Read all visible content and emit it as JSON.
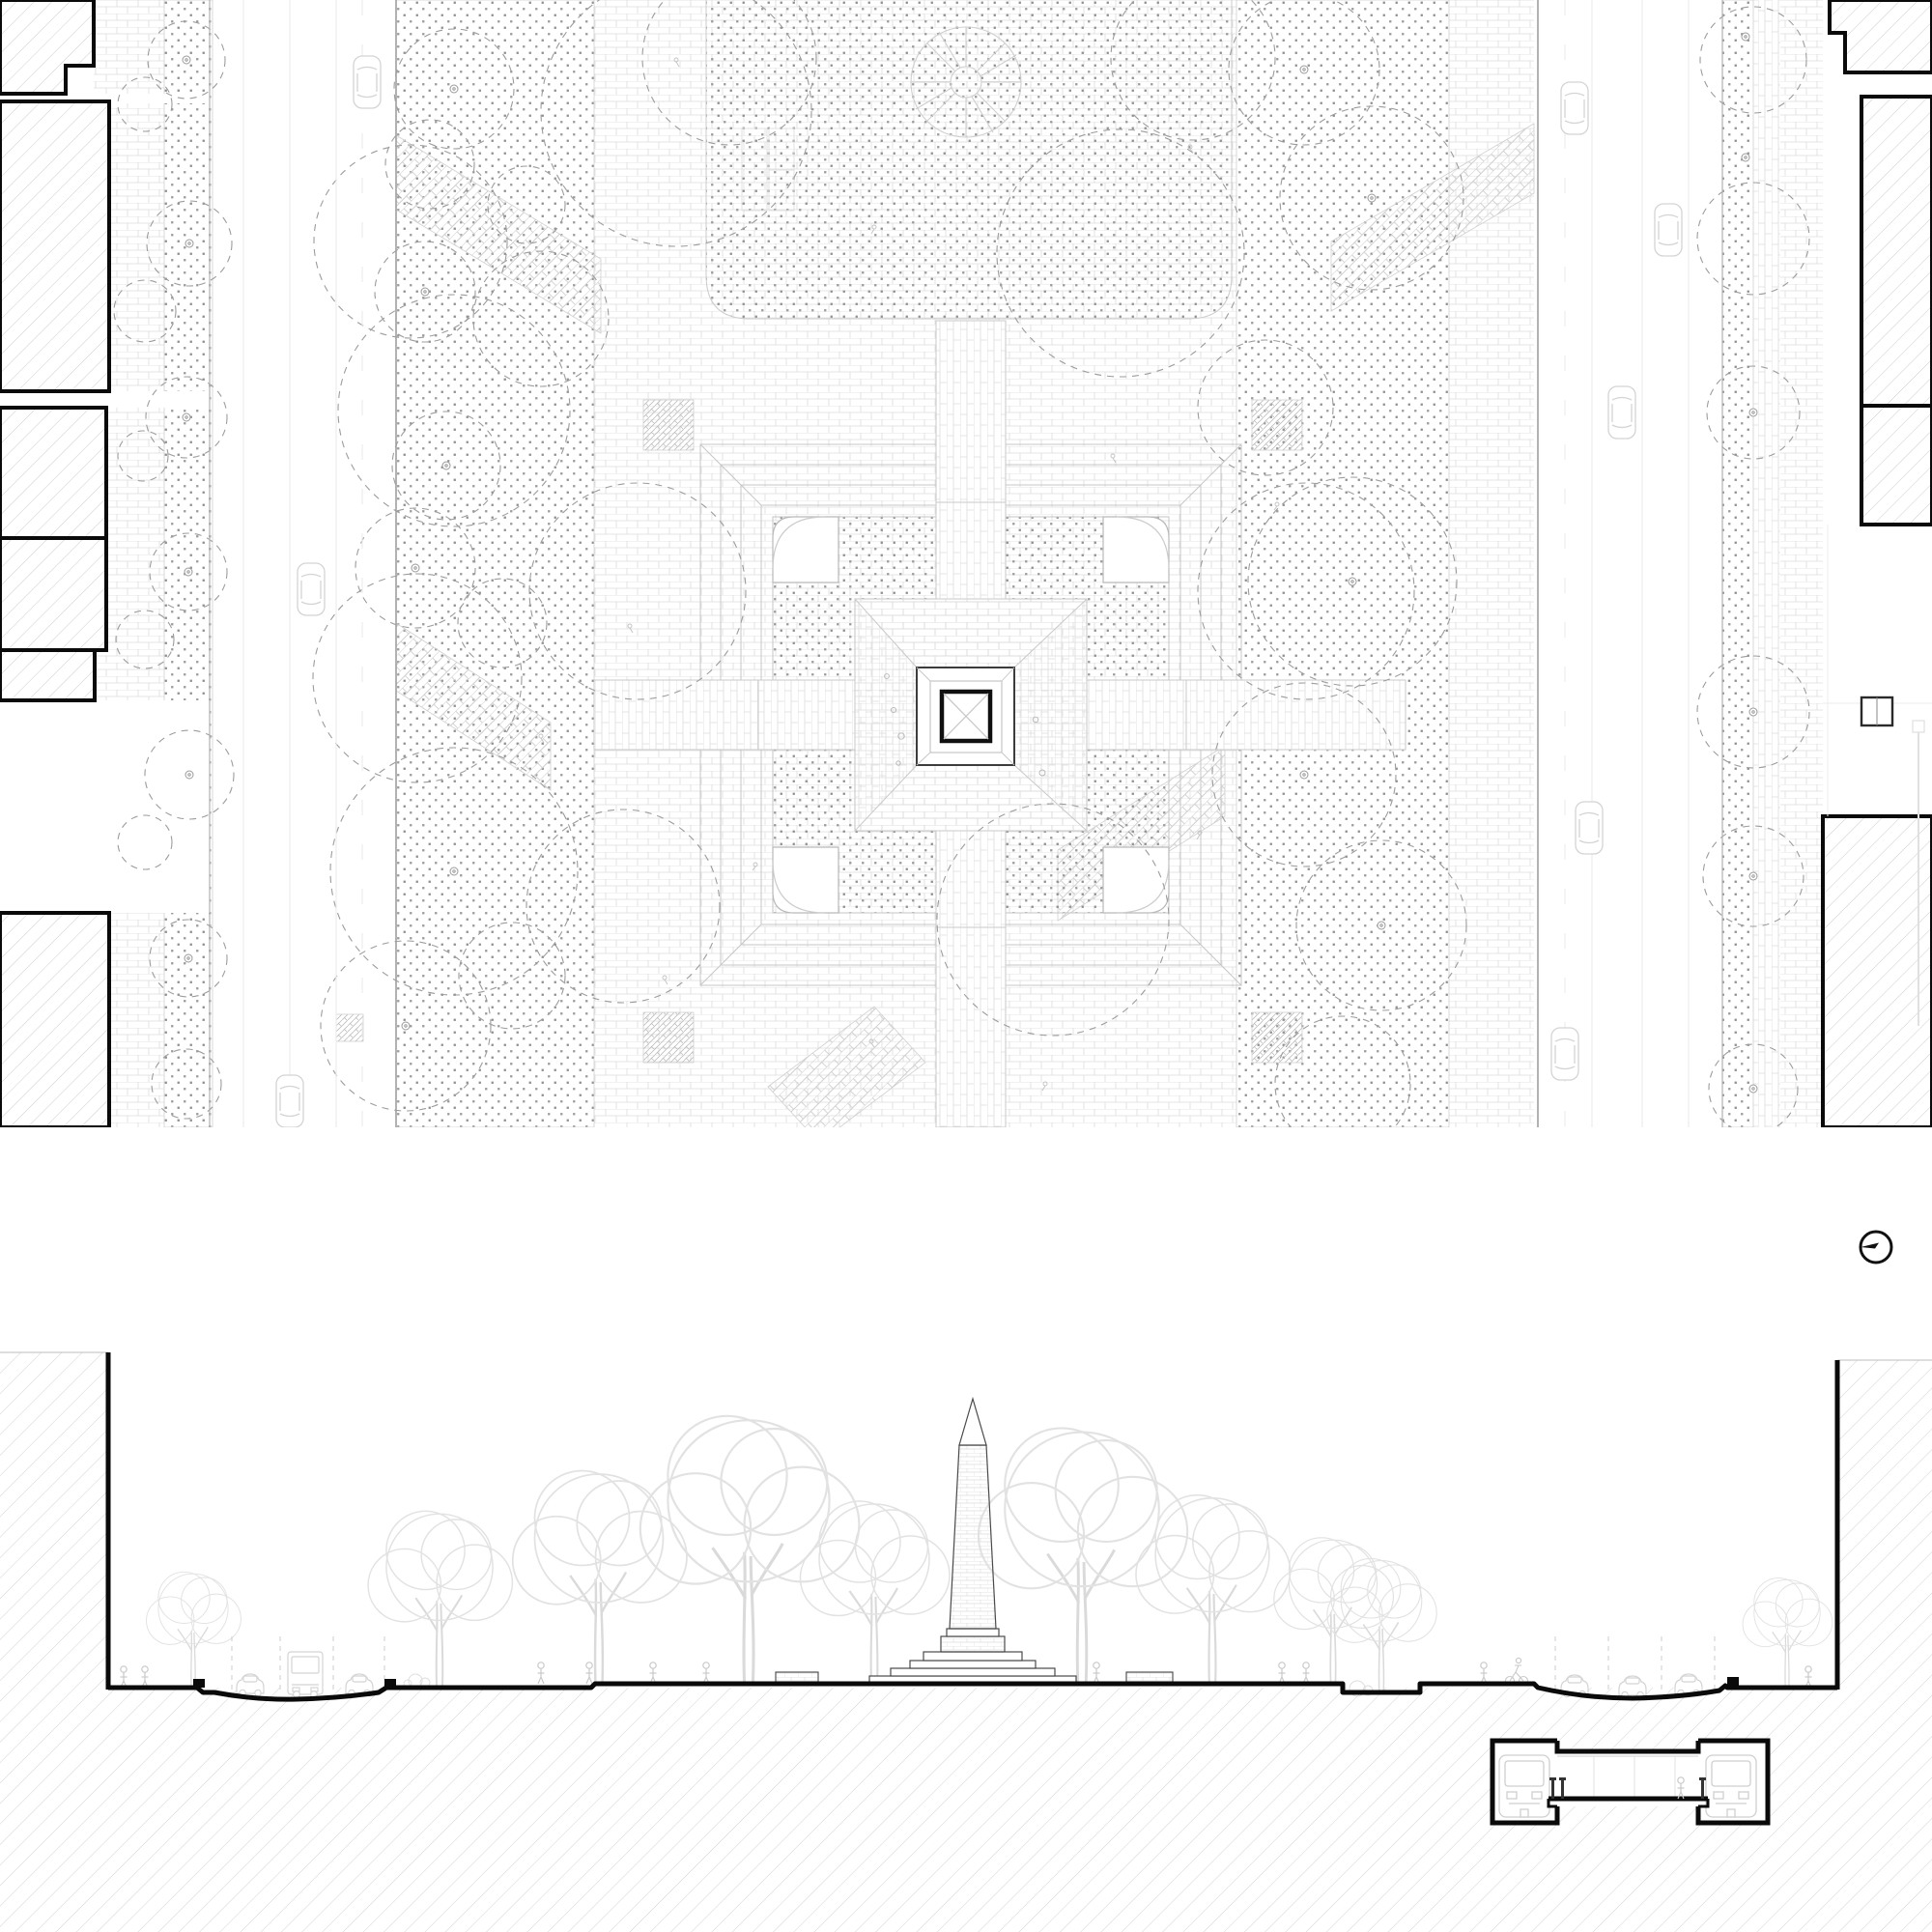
{
  "sheet": {
    "aria_label": "Monochrome architectural drawing sheet: site plan of an obelisk plaza at top, street section with underground station detail at bottom",
    "background": "#ffffff"
  },
  "palette": {
    "bold_outline": "#0a0a0a",
    "building_hatch": "#c6c6c6",
    "ground_poche": "#cccccc",
    "brick_joint": "#dcdcdc",
    "stipple_dot": "#8f8f8f",
    "tree_canopy_dash": "#9c9c9c",
    "terrace_line": "#c7c7c7",
    "curb_line": "#b0b0b0",
    "vehicle_line": "#d4d4d4",
    "figure_line": "#c9c9c9",
    "section_tree": "#e2e2e2"
  },
  "plan": {
    "aria_label": "Site plan: stepped obelisk plaza with lawns, dashed tree canopies, two one-way streets with cars, brick sidewalks and hatched perimeter buildings",
    "left_street_cars": 3,
    "right_street_cars": 5
  },
  "monument": {
    "aria_label": "Obelisk base in plan: bold square with cross braces on a stepped pyramid platform inside a square planting ring"
  },
  "north_arrow": {
    "icon": "north-arrow-icon",
    "aria_label": "North arrow: circle with needle pointing left"
  },
  "section": {
    "aria_label": "Section-elevation: obelisk on stepped base among street trees, cut buildings at both ends, hatched earth poche below grade",
    "vehicles_left": [
      "car",
      "bus",
      "car"
    ],
    "vehicles_right": [
      "car",
      "car",
      "car"
    ]
  },
  "station": {
    "aria_label": "Below-grade transit station detail: two train tunnels flanking a centre platform with columns and one passenger",
    "trains": 2
  }
}
